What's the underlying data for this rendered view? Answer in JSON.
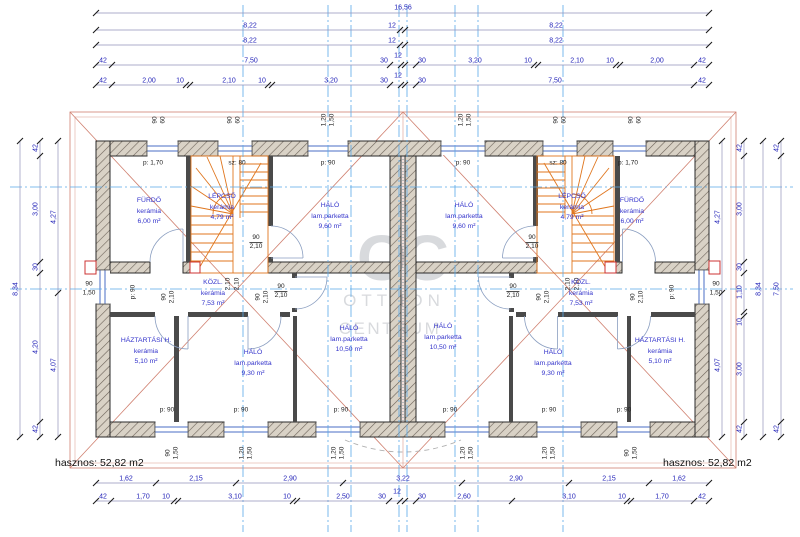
{
  "drawing": {
    "area_summary_left": "hasznos: 52,82 m2",
    "area_summary_right": "hasznos: 52,82 m2",
    "watermark": {
      "monogram": "OC",
      "line1": "OTTHON",
      "line2": "CENTRUM"
    }
  },
  "colors": {
    "dim_text": "#2323b8",
    "dim_line": "#9393ba",
    "tick": "#1a1a1a",
    "centerline": "#5aa9e8",
    "wall_edge": "#2a2a2a",
    "wall_fill": "#d9d2c6",
    "window": "#4a6cc4",
    "stair": "#e0761e",
    "roof": "#d08070",
    "room_text": "#3434cb",
    "opening_text": "#222222",
    "chimney": "#cc3333",
    "watermark": "#b9bcc3"
  },
  "rooms": [
    {
      "name": "FÜRDŐ",
      "material": "kerámia",
      "area": "6,00 m²",
      "x": 149,
      "y": 212
    },
    {
      "name": "LÉPCSŐ",
      "material": "kerámia",
      "area": "4,79 m²",
      "x": 222,
      "y": 208
    },
    {
      "name": "HÁLÓ",
      "material": "lam.parketta",
      "area": "9,60 m²",
      "x": 330,
      "y": 217
    },
    {
      "name": "KÖZL.",
      "material": "kerámia",
      "area": "7,53 m²",
      "x": 213,
      "y": 294
    },
    {
      "name": "HÁZTARTÁSI H.",
      "material": "kerámia",
      "area": "5,10 m²",
      "x": 146,
      "y": 352
    },
    {
      "name": "HÁLÓ",
      "material": "lam.parketta",
      "area": "9,30 m²",
      "x": 253,
      "y": 364
    },
    {
      "name": "HÁLÓ",
      "material": "lam.parketta",
      "area": "10,50 m²",
      "x": 349,
      "y": 340
    },
    {
      "name": "FÜRDŐ",
      "material": "kerámia",
      "area": "6,00 m²",
      "x": 632,
      "y": 212
    },
    {
      "name": "LÉPCSŐ",
      "material": "kerámia",
      "area": "4,79 m²",
      "x": 572,
      "y": 208
    },
    {
      "name": "HÁLÓ",
      "material": "lam.parketta",
      "area": "9,60 m²",
      "x": 464,
      "y": 217
    },
    {
      "name": "KÖZL.",
      "material": "kerámia",
      "area": "7,53 m²",
      "x": 581,
      "y": 294
    },
    {
      "name": "HÁZTARTÁSI H.",
      "material": "kerámia",
      "area": "5,10 m²",
      "x": 660,
      "y": 352
    },
    {
      "name": "HÁLÓ",
      "material": "lam.parketta",
      "area": "9,30 m²",
      "x": 553,
      "y": 364
    },
    {
      "name": "HÁLÓ",
      "material": "lam.parketta",
      "area": "10,50 m²",
      "x": 443,
      "y": 338
    }
  ],
  "plan_labels": [
    {
      "t": "p: 1,70",
      "x": 153,
      "y": 163
    },
    {
      "t": "sz: 80",
      "x": 237,
      "y": 163
    },
    {
      "t": "p: 90",
      "x": 328,
      "y": 163
    },
    {
      "t": "p: 90",
      "x": 463,
      "y": 163
    },
    {
      "t": "sz: 80",
      "x": 558,
      "y": 163
    },
    {
      "t": "p: 1,70",
      "x": 628,
      "y": 163
    },
    {
      "t": "p: 90",
      "x": 167,
      "y": 410
    },
    {
      "t": "p: 90",
      "x": 241,
      "y": 410
    },
    {
      "t": "p: 90",
      "x": 341,
      "y": 410
    },
    {
      "t": "p: 90",
      "x": 450,
      "y": 410
    },
    {
      "t": "p: 90",
      "x": 549,
      "y": 410
    },
    {
      "t": "p: 90",
      "x": 624,
      "y": 410
    },
    {
      "t": "90",
      "x": 155,
      "y": 120,
      "r": 1
    },
    {
      "t": "60",
      "x": 163,
      "y": 120,
      "r": 1
    },
    {
      "t": "90",
      "x": 230,
      "y": 120,
      "r": 1
    },
    {
      "t": "60",
      "x": 238,
      "y": 120,
      "r": 1
    },
    {
      "t": "1,20",
      "x": 324,
      "y": 120,
      "r": 1
    },
    {
      "t": "1,50",
      "x": 332,
      "y": 120,
      "r": 1
    },
    {
      "t": "1,20",
      "x": 461,
      "y": 120,
      "r": 1
    },
    {
      "t": "1,50",
      "x": 469,
      "y": 120,
      "r": 1
    },
    {
      "t": "90",
      "x": 556,
      "y": 120,
      "r": 1
    },
    {
      "t": "60",
      "x": 564,
      "y": 120,
      "r": 1
    },
    {
      "t": "90",
      "x": 631,
      "y": 120,
      "r": 1
    },
    {
      "t": "60",
      "x": 639,
      "y": 120,
      "r": 1
    },
    {
      "t": "90",
      "x": 168,
      "y": 453,
      "r": 1
    },
    {
      "t": "1,50",
      "x": 176,
      "y": 453,
      "r": 1
    },
    {
      "t": "1,20",
      "x": 242,
      "y": 453,
      "r": 1
    },
    {
      "t": "1,50",
      "x": 250,
      "y": 453,
      "r": 1
    },
    {
      "t": "1,20",
      "x": 334,
      "y": 453,
      "r": 1
    },
    {
      "t": "1,50",
      "x": 342,
      "y": 453,
      "r": 1
    },
    {
      "t": "1,20",
      "x": 463,
      "y": 453,
      "r": 1
    },
    {
      "t": "1,50",
      "x": 471,
      "y": 453,
      "r": 1
    },
    {
      "t": "1,20",
      "x": 545,
      "y": 453,
      "r": 1
    },
    {
      "t": "1,50",
      "x": 553,
      "y": 453,
      "r": 1
    },
    {
      "t": "90",
      "x": 627,
      "y": 453,
      "r": 1
    },
    {
      "t": "1,50",
      "x": 635,
      "y": 453,
      "r": 1
    },
    {
      "t": "90",
      "x": 164,
      "y": 297,
      "r": 1
    },
    {
      "t": "2,10",
      "x": 172,
      "y": 297,
      "r": 1
    },
    {
      "t": "90",
      "x": 258,
      "y": 297,
      "r": 1
    },
    {
      "t": "2,10",
      "x": 266,
      "y": 297,
      "r": 1
    },
    {
      "t": "2,10",
      "x": 228,
      "y": 284,
      "r": 1
    },
    {
      "t": "2,10",
      "x": 237,
      "y": 284,
      "r": 1
    },
    {
      "t": "90",
      "x": 539,
      "y": 297,
      "r": 1
    },
    {
      "t": "2,10",
      "x": 547,
      "y": 297,
      "r": 1
    },
    {
      "t": "90",
      "x": 633,
      "y": 297,
      "r": 1
    },
    {
      "t": "2,10",
      "x": 641,
      "y": 297,
      "r": 1
    },
    {
      "t": "2,10",
      "x": 568,
      "y": 284,
      "r": 1
    },
    {
      "t": "2,10",
      "x": 577,
      "y": 284,
      "r": 1
    },
    {
      "t": "p: 90",
      "x": 133,
      "y": 292,
      "r": 1
    },
    {
      "t": "p: 90",
      "x": 672,
      "y": 292,
      "r": 1
    },
    {
      "t": "90",
      "x": 89,
      "y": 284
    },
    {
      "t": "1,50",
      "x": 89,
      "y": 293
    },
    {
      "t": "90",
      "x": 716,
      "y": 284
    },
    {
      "t": "1,50",
      "x": 716,
      "y": 293
    }
  ],
  "frac_labels": [
    {
      "top": "90",
      "bottom": "2,10",
      "x": 256,
      "y": 243
    },
    {
      "top": "90",
      "bottom": "2,10",
      "x": 532,
      "y": 243
    },
    {
      "top": "90",
      "bottom": "2,10",
      "x": 281,
      "y": 292
    },
    {
      "top": "90",
      "bottom": "2,10",
      "x": 513,
      "y": 292
    }
  ],
  "dimensions": {
    "horizontal_rows": [
      {
        "y": 13,
        "x1": 96,
        "x2": 709,
        "boundaries": [
          96,
          709
        ],
        "labels": [
          {
            "t": "16,56",
            "x": 403,
            "y": 8
          }
        ]
      },
      {
        "y": 30,
        "x1": 96,
        "x2": 709,
        "boundaries": [
          96,
          400,
          405,
          709
        ],
        "labels": [
          {
            "t": "8,22",
            "x": 250,
            "y": 26
          },
          {
            "t": "12",
            "x": 392,
            "y": 26
          },
          {
            "t": "8,22",
            "x": 556,
            "y": 26
          }
        ]
      },
      {
        "y": 45,
        "x1": 96,
        "x2": 709,
        "boundaries": [
          96,
          400,
          405,
          709
        ],
        "labels": [
          {
            "t": "8,22",
            "x": 250,
            "y": 41
          },
          {
            "t": "12",
            "x": 392,
            "y": 41
          },
          {
            "t": "8,22",
            "x": 556,
            "y": 41
          }
        ]
      },
      {
        "y": 65,
        "x1": 96,
        "x2": 709,
        "boundaries": [
          96,
          112,
          390,
          401,
          405,
          416,
          534,
          538,
          616,
          620,
          694,
          709
        ],
        "labels": [
          {
            "t": "42",
            "x": 103,
            "y": 61
          },
          {
            "t": "7,50",
            "x": 251,
            "y": 61
          },
          {
            "t": "30",
            "x": 384,
            "y": 61
          },
          {
            "t": "12",
            "x": 398,
            "y": 56
          },
          {
            "t": "30",
            "x": 422,
            "y": 61
          },
          {
            "t": "3,20",
            "x": 475,
            "y": 61
          },
          {
            "t": "10",
            "x": 528,
            "y": 61
          },
          {
            "t": "2,10",
            "x": 577,
            "y": 61
          },
          {
            "t": "10",
            "x": 610,
            "y": 61
          },
          {
            "t": "2,00",
            "x": 657,
            "y": 61
          },
          {
            "t": "42",
            "x": 702,
            "y": 61
          }
        ]
      },
      {
        "y": 85,
        "x1": 96,
        "x2": 709,
        "boundaries": [
          96,
          112,
          186,
          190,
          268,
          272,
          390,
          401,
          405,
          416,
          694,
          709
        ],
        "labels": [
          {
            "t": "42",
            "x": 103,
            "y": 81
          },
          {
            "t": "2,00",
            "x": 149,
            "y": 81
          },
          {
            "t": "10",
            "x": 180,
            "y": 81
          },
          {
            "t": "2,10",
            "x": 229,
            "y": 81
          },
          {
            "t": "10",
            "x": 262,
            "y": 81
          },
          {
            "t": "3,20",
            "x": 331,
            "y": 81
          },
          {
            "t": "30",
            "x": 384,
            "y": 81
          },
          {
            "t": "12",
            "x": 398,
            "y": 76
          },
          {
            "t": "30",
            "x": 422,
            "y": 81
          },
          {
            "t": "7,50",
            "x": 555,
            "y": 81
          },
          {
            "t": "42",
            "x": 702,
            "y": 81
          }
        ]
      },
      {
        "y": 483,
        "x1": 96,
        "x2": 709,
        "boundaries": [
          96,
          156,
          236,
          343,
          462,
          569,
          649,
          709
        ],
        "labels": [
          {
            "t": "1,62",
            "x": 126,
            "y": 479
          },
          {
            "t": "2,15",
            "x": 196,
            "y": 479
          },
          {
            "t": "2,90",
            "x": 290,
            "y": 479
          },
          {
            "t": "3,22",
            "x": 403,
            "y": 479
          },
          {
            "t": "2,90",
            "x": 516,
            "y": 479
          },
          {
            "t": "2,15",
            "x": 609,
            "y": 479
          },
          {
            "t": "1,62",
            "x": 679,
            "y": 479
          }
        ]
      },
      {
        "y": 501,
        "x1": 96,
        "x2": 709,
        "boundaries": [
          96,
          111,
          174,
          178,
          293,
          297,
          389,
          400,
          405,
          416,
          512,
          627,
          631,
          694,
          709
        ],
        "labels": [
          {
            "t": "42",
            "x": 103,
            "y": 497
          },
          {
            "t": "1,70",
            "x": 143,
            "y": 497
          },
          {
            "t": "10",
            "x": 166,
            "y": 497
          },
          {
            "t": "3,10",
            "x": 235,
            "y": 497
          },
          {
            "t": "10",
            "x": 287,
            "y": 497
          },
          {
            "t": "2,50",
            "x": 343,
            "y": 497
          },
          {
            "t": "30",
            "x": 382,
            "y": 497
          },
          {
            "t": "12",
            "x": 397,
            "y": 492
          },
          {
            "t": "30",
            "x": 422,
            "y": 497
          },
          {
            "t": "2,60",
            "x": 464,
            "y": 497
          },
          {
            "t": "3,10",
            "x": 569,
            "y": 497
          },
          {
            "t": "10",
            "x": 622,
            "y": 497
          },
          {
            "t": "1,70",
            "x": 662,
            "y": 497
          },
          {
            "t": "42",
            "x": 702,
            "y": 497
          }
        ]
      }
    ],
    "vertical_cols": [
      {
        "x": 20,
        "y1": 141,
        "y2": 437,
        "boundaries": [
          141,
          437
        ],
        "labels": [
          {
            "t": "8,34",
            "y": 289
          }
        ]
      },
      {
        "x": 40,
        "y1": 141,
        "y2": 437,
        "boundaries": [
          141,
          156,
          262,
          273,
          422,
          437
        ],
        "labels": [
          {
            "t": "42",
            "y": 148
          },
          {
            "t": "3,00",
            "y": 209
          },
          {
            "t": "30",
            "y": 267
          },
          {
            "t": "4,20",
            "y": 347
          },
          {
            "t": "42",
            "y": 429
          }
        ]
      },
      {
        "x": 58,
        "y1": 141,
        "y2": 437,
        "boundaries": [
          141,
          293,
          437
        ],
        "labels": [
          {
            "t": "4,27",
            "y": 217
          },
          {
            "t": "4,07",
            "y": 365
          }
        ]
      },
      {
        "x": 722,
        "y1": 141,
        "y2": 437,
        "boundaries": [
          141,
          293,
          437
        ],
        "labels": [
          {
            "t": "4,27",
            "y": 217
          },
          {
            "t": "4,07",
            "y": 365
          }
        ]
      },
      {
        "x": 744,
        "y1": 141,
        "y2": 437,
        "boundaries": [
          141,
          156,
          262,
          273,
          312,
          316,
          422,
          437
        ],
        "labels": [
          {
            "t": "42",
            "y": 148
          },
          {
            "t": "3,00",
            "y": 209
          },
          {
            "t": "30",
            "y": 267
          },
          {
            "t": "1,10",
            "y": 292
          },
          {
            "t": "10",
            "y": 322
          },
          {
            "t": "3,00",
            "y": 369
          },
          {
            "t": "42",
            "y": 429
          }
        ]
      },
      {
        "x": 763,
        "y1": 141,
        "y2": 437,
        "boundaries": [
          141,
          437
        ],
        "labels": [
          {
            "t": "8,34",
            "y": 289
          }
        ]
      },
      {
        "x": 781,
        "y1": 141,
        "y2": 437,
        "boundaries": [
          141,
          156,
          422,
          437
        ],
        "labels": [
          {
            "t": "42",
            "y": 148
          },
          {
            "t": "7,50",
            "y": 289
          },
          {
            "t": "42",
            "y": 429
          }
        ]
      }
    ]
  }
}
